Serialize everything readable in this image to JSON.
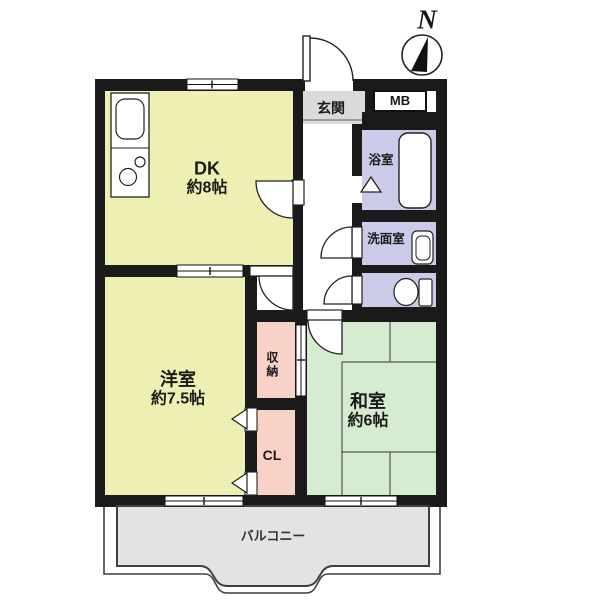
{
  "title": "apartment-floor-plan",
  "compass": {
    "label": "N"
  },
  "rooms": {
    "dk": {
      "label": "DK",
      "size": "約8帖",
      "color": "#eef0b3"
    },
    "western": {
      "label": "洋室",
      "size": "約7.5帖",
      "color": "#eef0b3"
    },
    "japanese": {
      "label": "和室",
      "size": "約6帖",
      "color": "#d5ecd1"
    },
    "entrance": {
      "label": "玄関",
      "color": "#dadada"
    },
    "meter_box": {
      "label": "MB",
      "color": "#ffffff"
    },
    "bathroom": {
      "label": "浴室",
      "color": "#cbcbe9"
    },
    "washroom": {
      "label": "洗面室",
      "color": "#cbcbe9"
    },
    "toilet": {
      "color": "#cbcbe9"
    },
    "storage": {
      "label": "収納",
      "color": "#f8d2c6"
    },
    "closet": {
      "label": "CL",
      "color": "#f8d2c6"
    },
    "hallway": {
      "color": "#ffffff"
    },
    "balcony": {
      "label": "バルコニー",
      "color": "#e3e3e3"
    }
  },
  "colors": {
    "wall": "#1a1a1a",
    "outline": "#222222",
    "tatami_line": "#555555",
    "balcony_outline": "#3f3f3f"
  }
}
